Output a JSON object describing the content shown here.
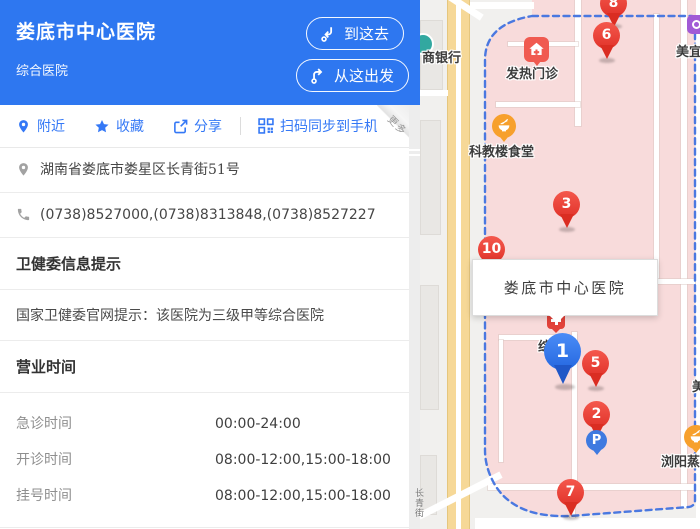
{
  "header": {
    "title": "娄底市中心医院",
    "subtitle": "综合医院",
    "go_button": "到这去",
    "depart_button": "从这出发"
  },
  "actions": {
    "nearby": "附近",
    "favorite": "收藏",
    "share": "分享",
    "sync": "扫码同步到手机",
    "more": "更多"
  },
  "contact": {
    "address": "湖南省娄底市娄星区长青街51号",
    "phone": "(0738)8527000,(0738)8313848,(0738)8527227"
  },
  "health": {
    "title": "卫健委信息提示",
    "content": "国家卫健委官网提示：该医院为三级甲等综合医院"
  },
  "hours": {
    "title": "营业时间",
    "rows": [
      {
        "label": "急诊时间",
        "value": "00:00-24:00"
      },
      {
        "label": "开诊时间",
        "value": "08:00-12:00,15:00-18:00"
      },
      {
        "label": "挂号时间",
        "value": "08:00-12:00,15:00-18:00"
      }
    ]
  },
  "map": {
    "info_box": "娄底市中心医院",
    "labels": {
      "bank": "商银行",
      "fever_clinic": "发热门诊",
      "canteen": "科教楼食堂",
      "building": "综",
      "store": "美宜",
      "store2": "美",
      "restaurant": "浏阳蒸",
      "street": "长青街"
    },
    "markers": [
      {
        "n": "8"
      },
      {
        "n": "6"
      },
      {
        "n": "3"
      },
      {
        "n": "10"
      },
      {
        "n": "5"
      },
      {
        "n": "2"
      },
      {
        "n": "7"
      },
      {
        "n": "1"
      }
    ],
    "parking": "P"
  },
  "colors": {
    "accent_blue": "#2e77f0",
    "action_blue": "#3478f6",
    "marker_red": "#ee4136",
    "marker_blue": "#2f7bf3",
    "campus_pink": "#f8dbdb",
    "boundary_blue": "#4a78e0",
    "road_yellow": "#f6d897"
  }
}
